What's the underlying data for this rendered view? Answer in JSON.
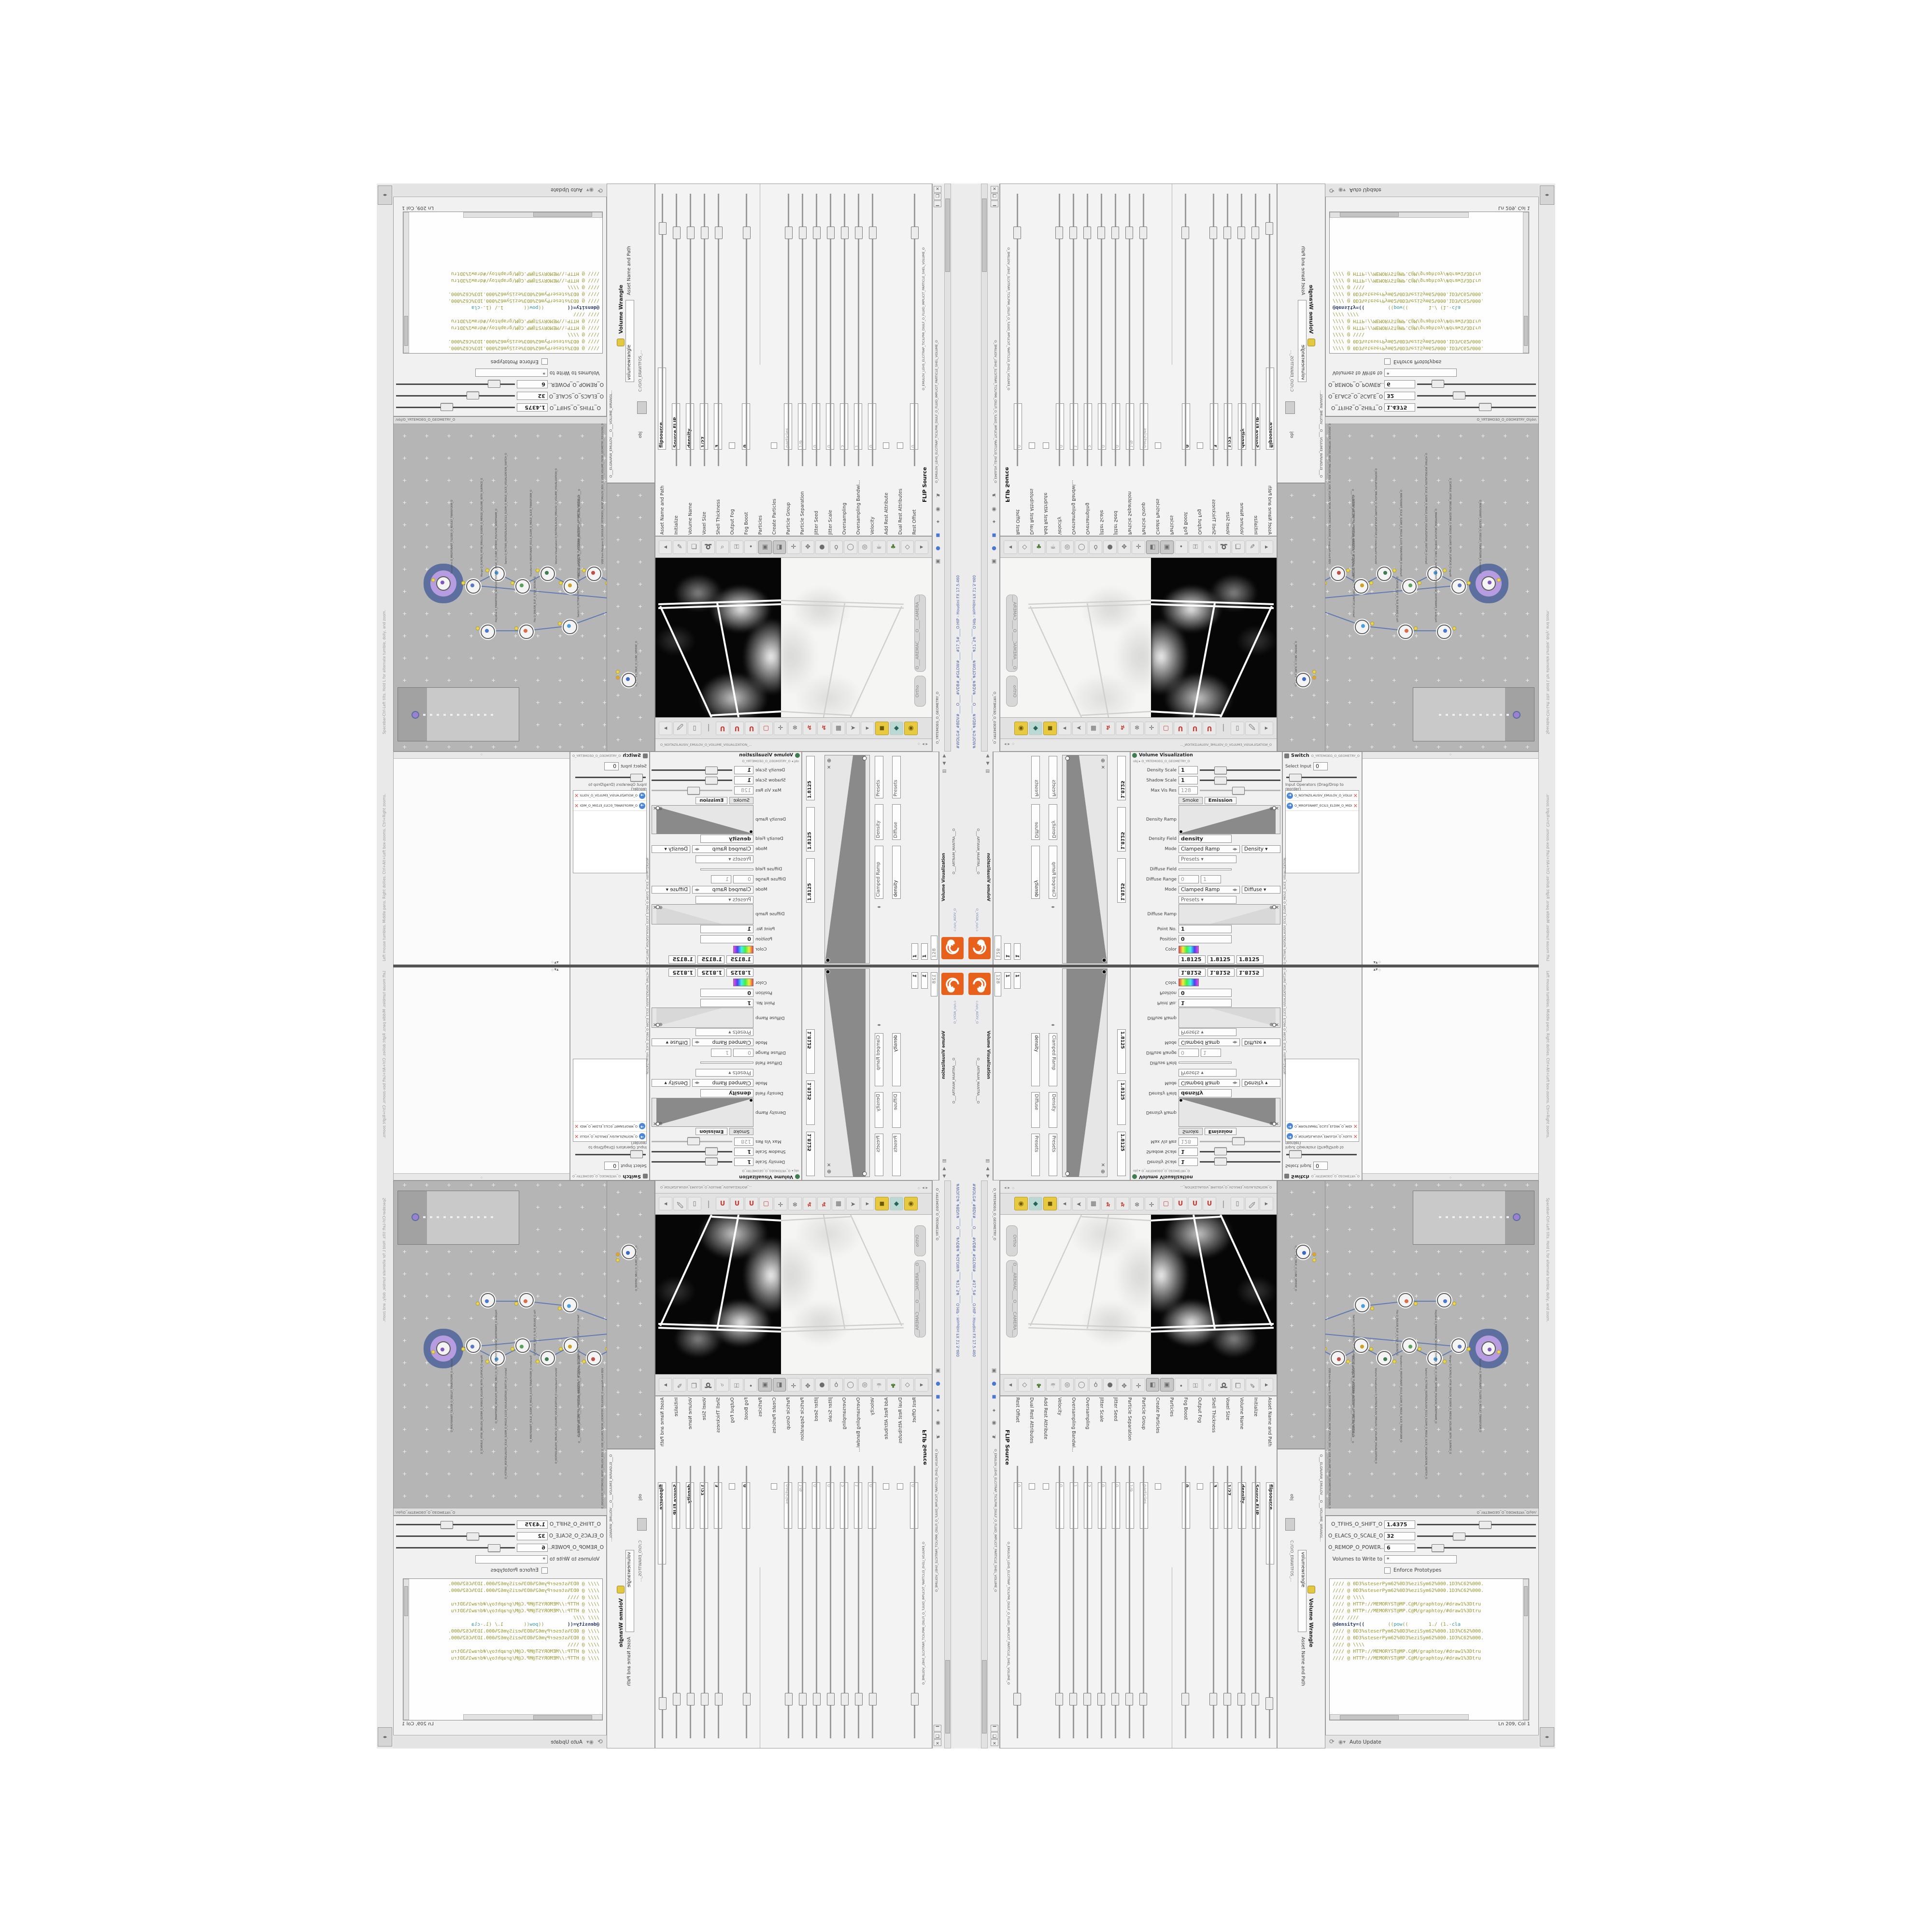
{
  "window": {
    "title": "#WOLG#_#BDV#____O____#VDB#_#GLOW#____#17_5#____O.HIP - Houdini FX 17.5.460",
    "buttons": {
      "close": "✕",
      "maximize": "❐",
      "minimize": "▁"
    },
    "center_path": "c:/o/o_AIDIV_O",
    "accent_orange": "#e8611c",
    "title_blue": "#4a5fa5"
  },
  "status": {
    "viewport_help": "Left mouse tumbles. Middle pans. Right dollies. Ctrl+Alt+Left box-zooms. Ctrl+Right zooms.",
    "viewport_help2": "Spacebar-Ctrl-Left tilts. Hold L for alternate tumble, dolly, and zoom.",
    "auto_update": "Auto Update",
    "ln_col": "Ln 209, Col 1"
  },
  "paths": {
    "obj": "obj",
    "geometry": "O_YRTEMOEG_O_GEOMETRY_O",
    "net_path": "/obj/O_YRTEMOEG_O_GEOMETRY_O",
    "software_path": "C:/O/O_ERAWTFOS_...",
    "watermark": "Geometry"
  },
  "tabs": {
    "flip_tab": "O_EMULOV_LEHS_ELCITRAP_TICILPMI_DIULF_O_FLUID_IMPLICIT_PARTICLE_SHEL_VOLUME_O",
    "wrangle_tab": "O___ELGNARW_EMULOV___O___VOLUME_WRANGL...",
    "vis_tab": "O_NOITAZILAUSIV_EMULOV_O_VOLUME_VISUALIZATION_...",
    "switch_tab": "O_HCTIWS_NOITAZILAUSIV_ECILS_ELDIM_O_MIDLE_SLICE_VISUALIZATION...",
    "mantra_tab": "O___ARTNAM_MANTRA___O"
  },
  "wrangle": {
    "title": "Volume Wrangle",
    "asset_label": "Asset Name and Path",
    "asset_value": "volumewrangle",
    "sliders": [
      {
        "label": "O_TFIHS_O_SHIFT_O",
        "value": "1.4375",
        "pos": 52
      },
      {
        "label": "O_ELACS_O_SCALE_O",
        "value": "32",
        "pos": 30
      },
      {
        "label": "O_REMOP_O_POWER...",
        "value": "6",
        "pos": 12
      }
    ],
    "volumes_label": "Volumes to Write to",
    "volumes_value": "*",
    "enforce_label": "Enforce Prototypes",
    "code_lines": [
      {
        "k": "olive",
        "s": "//// @ 0D3%steserPym62%0D3%eziSym62%000.1D3%C62%000."
      },
      {
        "k": "olive",
        "s": "//// @ 0D3%steserPym62%0D3%eziSym62%000.1D3%C62%000."
      },
      {
        "k": "olive",
        "s": "//// @ \\\\\\\\"
      },
      {
        "k": "olive",
        "s": "//// @ HTTP://MEMORYST@MP.C@M/graphtoy/#draw1%3Dtru"
      },
      {
        "k": "olive",
        "s": "//// @ HTTP://MEMORYST@MP.C@M/graphtoy/#draw1%3Dtru"
      },
      {
        "k": "olive",
        "s": "//// ////"
      },
      {
        "k": "mix",
        "s": "@density=((        ((pow((       1./ (1.-cla"
      },
      {
        "k": "olive",
        "s": "//// @ 0D3%steserPym62%0D3%eziSym62%000.1D3%C62%000."
      },
      {
        "k": "olive",
        "s": "//// @ 0D3%steserPym62%0D3%eziSym62%000.1D3%C62%000."
      },
      {
        "k": "olive",
        "s": "//// @ \\\\\\\\"
      },
      {
        "k": "olive",
        "s": "//// @ HTTP://MEMORYST@MP.C@M/graphtoy/#draw1%3Dtru"
      },
      {
        "k": "olive",
        "s": "//// @ HTTP://MEMORYST@MP.C@M/graphtoy/#draw1%3Dtru"
      }
    ]
  },
  "flip": {
    "title": "FLIP Source",
    "params": [
      {
        "label": "Asset Name and Path",
        "value": "flipsource",
        "kind": "field"
      },
      {
        "label": "Initialize",
        "value": "Source FLIP",
        "kind": "combo"
      },
      {
        "label": "Volume Name",
        "value": "density",
        "kind": "bold"
      },
      {
        "label": "Voxel Size",
        "value": "1/27",
        "kind": "yellow"
      },
      {
        "label": "Shell Thickness",
        "value": "3",
        "kind": "slider"
      },
      {
        "label": "Output Fog",
        "value": "",
        "kind": "check"
      },
      {
        "label": "Fog Boost",
        "value": "0",
        "kind": "dimslider"
      },
      {
        "label": "Particles",
        "value": "",
        "kind": "group"
      },
      {
        "label": "Create Particles",
        "value": "",
        "kind": "check"
      },
      {
        "label": "Particle Group",
        "value": "particles",
        "kind": "dim"
      },
      {
        "label": "Particle Separation",
        "value": "1/9",
        "kind": "dim"
      },
      {
        "label": "Jitter Seed",
        "value": "0",
        "kind": "dim"
      },
      {
        "label": "Jitter Scale",
        "value": "0",
        "kind": "dim"
      },
      {
        "label": "Oversampling",
        "value": "2",
        "kind": "dim"
      },
      {
        "label": "Oversampling Bandwi...",
        "value": "1",
        "kind": "dim"
      },
      {
        "label": "Velocity",
        "value": "0",
        "kind": "dim"
      },
      {
        "label": "Add Rest Attribute",
        "value": "",
        "kind": "check"
      },
      {
        "label": "Dual Rest Attributes",
        "value": "",
        "kind": "check"
      },
      {
        "label": "Rest Offset",
        "value": "0",
        "kind": "dim"
      }
    ]
  },
  "volvis": {
    "title": "Volume Visualization",
    "rows": [
      {
        "kind": "slider",
        "label": "Density Scale",
        "value": "1",
        "pos": 18
      },
      {
        "kind": "slider",
        "label": "Shadow Scale",
        "value": "1",
        "pos": 18
      },
      {
        "kind": "dimslider",
        "label": "Max Vis Res",
        "value": "128",
        "pos": 40
      },
      {
        "kind": "tabs",
        "label": "",
        "value": ""
      },
      {
        "kind": "ramp",
        "label": "Density Ramp",
        "value": ""
      },
      {
        "kind": "field",
        "label": "Density Field",
        "value": "density"
      },
      {
        "kind": "mode",
        "label": "Mode",
        "value": "Clamped Ramp",
        "extra": "Density"
      },
      {
        "kind": "presets",
        "label": "",
        "value": "Presets"
      },
      {
        "kind": "dim",
        "label": "Diffuse Field",
        "value": ""
      },
      {
        "kind": "range",
        "label": "Diffuse Range",
        "value": "0",
        "extra": "1"
      },
      {
        "kind": "mode",
        "label": "Mode",
        "value": "Clamped Ramp",
        "extra": "Diffuse"
      },
      {
        "kind": "presets",
        "label": "",
        "value": "Presets"
      },
      {
        "kind": "ramp2",
        "label": "Diffuse Ramp",
        "value": ""
      },
      {
        "kind": "field",
        "label": "Point No.",
        "value": "1"
      },
      {
        "kind": "field",
        "label": "Position",
        "value": "0"
      },
      {
        "kind": "color",
        "label": "Color",
        "value": ""
      },
      {
        "kind": "vec3",
        "label": "",
        "value": "1.8125"
      },
      {
        "kind": "combo",
        "label": "Interpolation",
        "value": "Linear"
      }
    ],
    "tab_smoke": "Smoke",
    "tab_emission": "Emission",
    "vals_128": [
      "1",
      "1",
      "128"
    ],
    "v1825": "1.8125"
  },
  "switch": {
    "title": "Switch",
    "select_label": "Select Input",
    "select_value": "0",
    "list_label": "Input Operators (Drag/Drop to reorder)",
    "items": [
      "O_NOITAZILAUSIV_EMULOV_O_VOLUME_VISUALIZATION_O",
      "O_MROFSNART_ECILS_ELDIM_O_MIDLE_SLICE_TRANSFORM_O"
    ]
  },
  "viewport": {
    "camera_pill": "O___AREMAC____O____CAMERA___O",
    "ortho_pill": "Ortho",
    "display_icons": [
      "arrow-left",
      "pen",
      "layers",
      "lasso",
      "wand",
      "key",
      "dot",
      "view-a",
      "view-b",
      "pivot",
      "handles",
      "ball",
      "bulb",
      "sphere",
      "ring",
      "mug",
      "tree",
      "diamond",
      "arrow-right"
    ],
    "snap_icons": [
      "arrow-left",
      "brush",
      "doc",
      "sep",
      "magnet",
      "magnet",
      "magnet",
      "magnet-box",
      "axis",
      "snowflake",
      "jack",
      "jack",
      "chip",
      "cursor",
      "arrow-right",
      "cube",
      "gem",
      "lamp"
    ]
  },
  "network": {
    "nodes": [
      {
        "type": "Transform",
        "name": "O_MROFSNART_TLUSER_O_RESULT_TRANSFORM_O",
        "big": true,
        "color": "#7e57c2"
      },
      {
        "type": "Merge",
        "name": "O_ECAFRUS_HTIW_EMULOV_EGREM_O_MERGE_VOLUME_WITH_SURFACE_O",
        "color": "#5b79c0"
      },
      {
        "type": "Switch",
        "name": "O_HCTIWS_NOITAZILAUSIV_ECILS_ELDIM_O_MIDLE_SLICE_VISUALIZATION_SWITCH_O",
        "color": "#4aa0d8"
      },
      {
        "type": "Transform",
        "name": "O_MROFSNART_ECILS_ELDIM_O_MIDLE_SLICE_TRANSFORM_O",
        "color": "#57a05a"
      },
      {
        "type": "Volume Visualization",
        "name": "O_NOITAZILAUSIV_EMULOV_O_VOLUME_VISUALIZATION_O",
        "color": "#3e7d4f"
      },
      {
        "type": "Volume Wrangle",
        "name": "O___ELGNARW_EMULOV___O___VOLUME_WRANGLE___O",
        "color": "#c9a227"
      },
      {
        "type": "VDB from Polygons",
        "name": "O_SNOGILOP_YRTEMOEG_MORF_EMULOV_BDV_O_VDB_VOLUME_FROM_GEOMETRY_POLYGONS_O",
        "color": "#c05046"
      },
      {
        "type": "FLIP Source",
        "name": "O_EMULOV_LEHS_ELCITRAP_TICILPMI_DIULF_O_FLUID_IMPLICIT_PARTICLE_SHEL_VOLUME_O",
        "color": "#ffffff",
        "ring": "#c08080"
      },
      {
        "type": "Clip",
        "name": "O_PILC_O_CLIP_O",
        "color": "#d98a3a"
      },
      {
        "type": "Clip",
        "name": "O_PILC_O_CLIP_O",
        "color": "#d98a3a"
      },
      {
        "type": "Switch",
        "name": "O_HCTIWS_YRTEMOEG_LANRETXE_LANRETNI_O_INTERNAL_EXTERNAL_GEOMETRY_SWITCH_O",
        "color": "#4aa0d8"
      },
      {
        "type": "File",
        "name": "O_DNUOB_ELIF_O_FILE_BOUND_O",
        "color": "#e06a4a"
      },
      {
        "type": "PolyWire",
        "name": "O_EMARFERIW_NOGYLOP_EREHPS_EBUC_O_CUBE_SPHERE_POLYGON_WIREFRAME_O",
        "color": "#4a78d0"
      },
      {
        "type": "CubeSphere",
        "name": "O_EREHPS_EBUC_O_CUBE_SPHERE_O",
        "color": "#3a6ac8"
      }
    ],
    "red_label": "O_SLPIRT.STEP.SERA.OBJ",
    "bg": "#b5b5b5"
  },
  "header_icons": [
    "▲",
    "▼",
    "▤",
    "obj",
    "●",
    "⚙",
    "H",
    "⌕",
    "i",
    "?"
  ]
}
